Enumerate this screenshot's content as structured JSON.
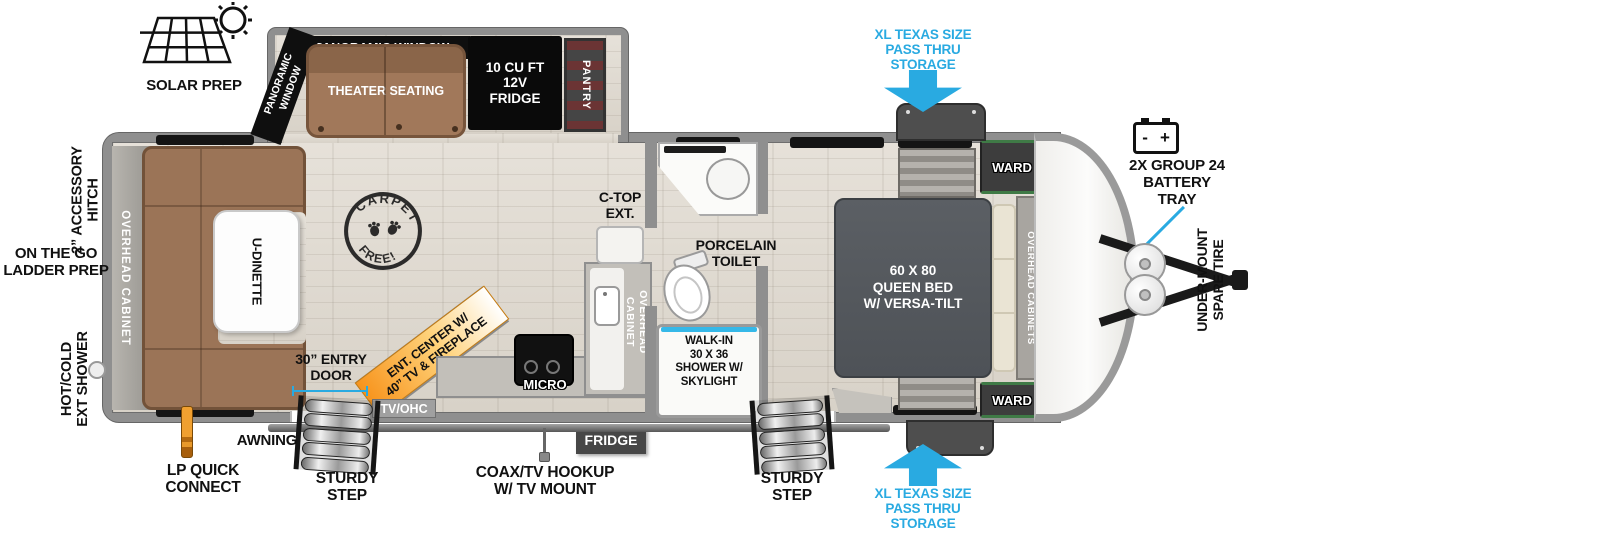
{
  "colors": {
    "callout_blue": "#29aae1",
    "wall_gray": "#8f8f8f",
    "furniture_brown": "#a1785a",
    "bed_gray": "#55595e",
    "ent_center_orange": "#f7941d",
    "lp_orange": "#e08b28"
  },
  "exterior": {
    "solar_prep": "SOLAR PREP",
    "pass_thru_top": "XL TEXAS SIZE\nPASS THRU\nSTORAGE",
    "pass_thru_bottom": "XL TEXAS SIZE\nPASS THRU\nSTORAGE",
    "battery_tray": "2X GROUP 24\nBATTERY\nTRAY",
    "battery_minus": "-",
    "battery_plus": "+",
    "spare_tire": "UNDER-MOUNT\nSPARE TIRE",
    "accessory_hitch": "2” ACCESSORY\nHITCH",
    "ladder_prep": "ON THE GO\nLADDER PREP",
    "ext_shower": "HOT/COLD\nEXT SHOWER",
    "lp_quick_connect": "LP QUICK\nCONNECT",
    "awning": "AWNING",
    "sturdy_step_left": "STURDY\nSTEP",
    "sturdy_step_right": "STURDY\nSTEP",
    "coax_tv": "COAX/TV HOOKUP\nW/ TV MOUNT"
  },
  "slide_out": {
    "panoramic_window_top": "PANORAMIC WINDOW",
    "panoramic_window_side": "PANORAMIC\nWINDOW",
    "theater_seating": "THEATER SEATING",
    "fridge_12v": "10 CU FT\n12V\nFRIDGE",
    "pantry": "PANTRY"
  },
  "interior": {
    "rear_overhead_cabinet": "OVERHEAD CABINET",
    "rear_panoramic_window": "PANORAMIC WINDOW",
    "u_dinette": "U-DINETTE",
    "carpet_free_top": "CARPET",
    "carpet_free_bottom": "FREE!",
    "entry_door": "30” ENTRY\nDOOR",
    "ent_center": "ENT. CENTER W/\n40” TV & FIREPLACE",
    "tv_ohc": "TV/OHC",
    "micro": "MICRO",
    "fridge": "FRIDGE",
    "kitchen_overhead_cabinet": "OVERHEAD\nCABINET",
    "ctop_ext": "C-TOP\nEXT.",
    "porcelain_toilet": "PORCELAIN\nTOILET",
    "shower": "WALK-IN\n30 X 36\nSHOWER W/\nSKYLIGHT",
    "queen_bed": "60 X  80\nQUEEN BED\nW/ VERSA-TILT",
    "overhead_cabinets_bed": "OVERHEAD CABINETS",
    "ward_top": "WARD",
    "ward_bottom": "WARD"
  },
  "icons": {
    "solar": "solar-panel-sun",
    "battery": "battery-terminals",
    "arrows": "block-arrow",
    "stamp": "paw-print-stamp",
    "lp": "lp-hose-nozzle",
    "shower_port": "exterior-shower-port",
    "coax": "coax-antenna",
    "propane": "propane-tanks",
    "hitch": "a-frame-tongue"
  }
}
